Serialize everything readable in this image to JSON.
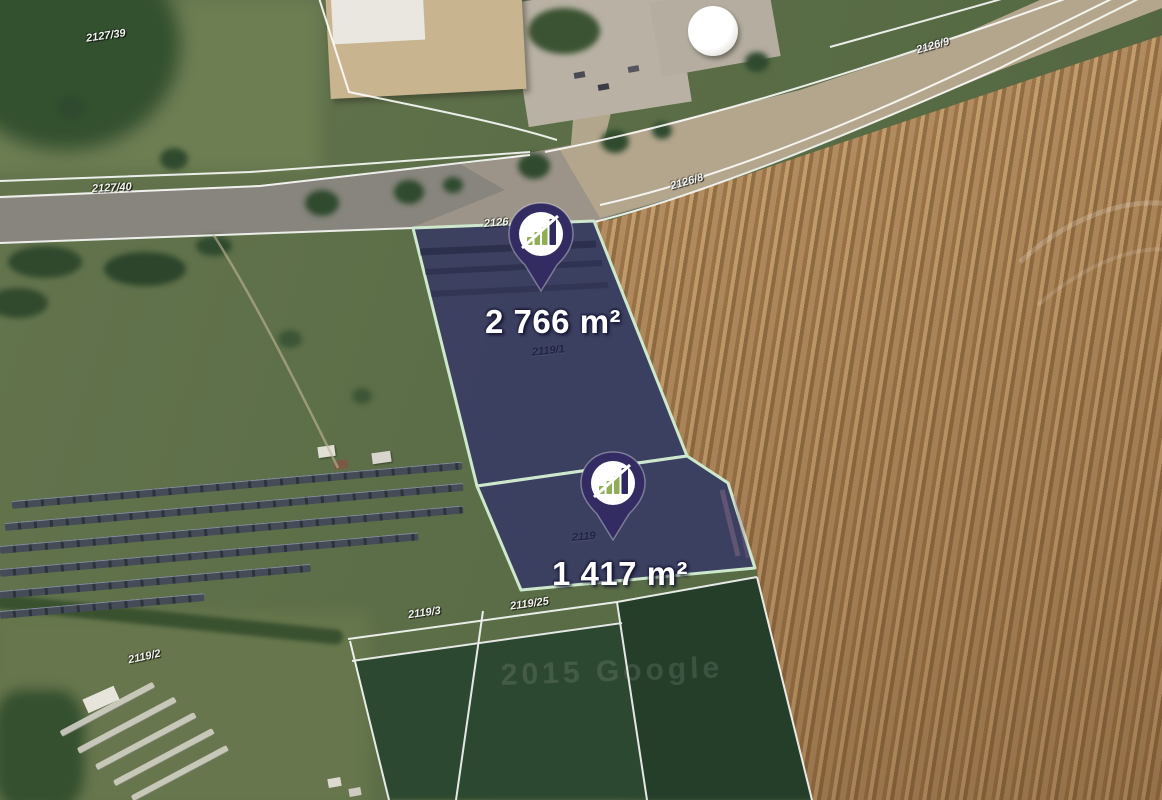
{
  "map": {
    "type": "satellite-cadastral-view",
    "watermark": "2015 Google",
    "area_unit": "m²",
    "parcels": [
      {
        "cadastral_number": "2119/1",
        "area_label": "2 766 m²"
      },
      {
        "cadastral_number": "2119",
        "area_label": "1 417 m²"
      }
    ],
    "cadastral_labels": [
      {
        "text": "2127/39"
      },
      {
        "text": "2127/40"
      },
      {
        "text": "2126/9"
      },
      {
        "text": "2126/8"
      },
      {
        "text": "2126"
      },
      {
        "text": "2119/1"
      },
      {
        "text": "2119"
      },
      {
        "text": "2119/3"
      },
      {
        "text": "2119/25"
      },
      {
        "text": "2119/2"
      }
    ],
    "pins": [
      {
        "label": "parcel-pin-1",
        "icon": "bar-chart-logo-icon"
      },
      {
        "label": "parcel-pin-2",
        "icon": "bar-chart-logo-icon"
      }
    ],
    "colors": {
      "parcel_fill": "#323069",
      "parcel_border": "#cde8cd",
      "pin_body": "#332c63",
      "pin_logo_green": "#8fae56",
      "pin_logo_dark": "#2e2a5e",
      "field_brown": "#a98157",
      "field_green": "#5c6f48",
      "boundary_line": "#ffffff"
    }
  }
}
